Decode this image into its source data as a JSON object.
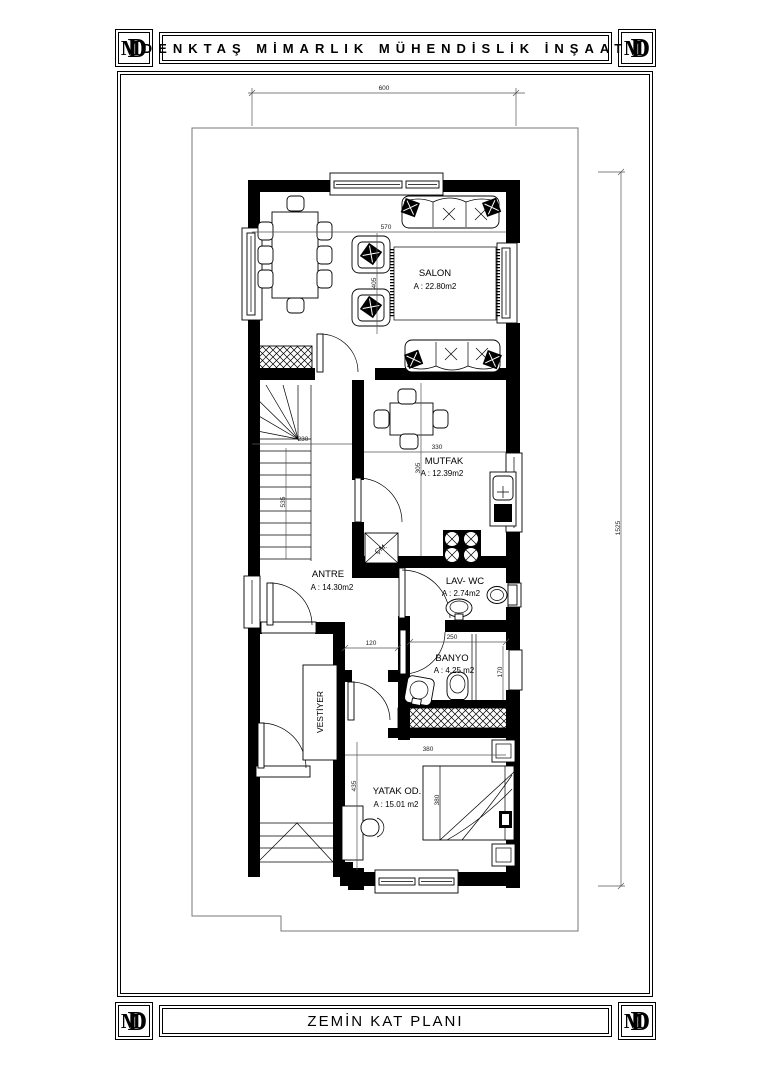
{
  "header": {
    "logo": "MD",
    "title": "DENKTAŞ MİMARLIK MÜHENDİSLİK İNŞAAT"
  },
  "footer": {
    "logo": "MD",
    "title": "ZEMİN KAT PLANI"
  },
  "rooms": {
    "salon": {
      "name": "SALON",
      "area": "A : 22.80m2"
    },
    "mutfak": {
      "name": "MUTFAK",
      "area": "A : 12.39m2"
    },
    "antre": {
      "name": "ANTRE",
      "area": "A : 14.30m2"
    },
    "lavwc": {
      "name": "LAV- WC",
      "area": "A : 2.74m2"
    },
    "banyo": {
      "name": "BANYO",
      "area": "A : 4.25 m2"
    },
    "yatak": {
      "name": "YATAK OD.",
      "area": "A : 15.01 m2"
    },
    "vestiyer": {
      "name": "VESTİYER"
    },
    "appliance_cm": "ÇM."
  },
  "dimensions": {
    "total_width": "600",
    "total_height": "1525",
    "salon_width": "570",
    "salon_height": "405",
    "stairs_width": "230",
    "stairs_height": "535",
    "mutfak_width": "330",
    "mutfak_height": "305",
    "koridor_width": "120",
    "banyo_width": "250",
    "banyo_height": "170",
    "yatak_width": "380",
    "yatak_height": "435",
    "bed_length": "380"
  }
}
